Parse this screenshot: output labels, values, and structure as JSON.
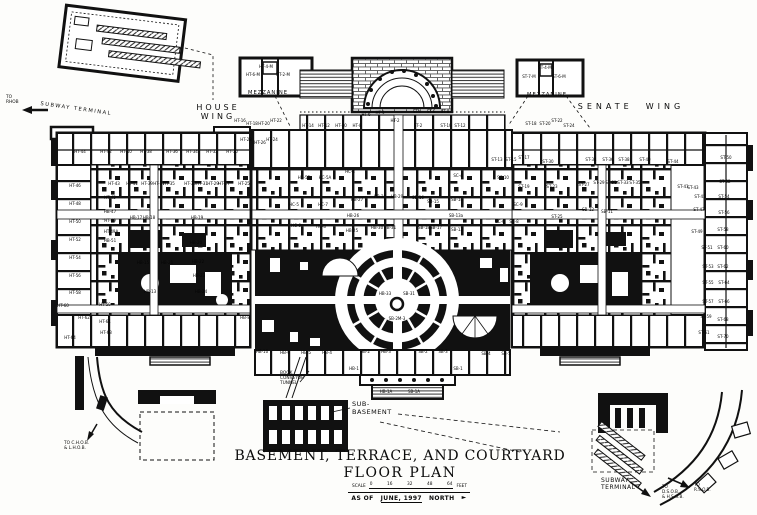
{
  "title": {
    "line1": "BASEMENT, TERRACE, AND COURTYARD",
    "line2": "FLOOR PLAN"
  },
  "scale_bar": {
    "label": "SCALE",
    "ticks": [
      "0",
      "16",
      "32",
      "48",
      "64"
    ],
    "unit": "FEET"
  },
  "date_line": {
    "as_of": "AS OF",
    "date": "JUNE, 1997",
    "north": "NORTH",
    "arrow": "►"
  },
  "annotations": [
    {
      "name": "to-rhob-label",
      "lines": [
        "TO",
        "RHOB"
      ],
      "x": 6,
      "y": 95,
      "size": 4.3
    },
    {
      "name": "nw-subway-terminal-label",
      "lines": [
        "SUBWAY TERMINAL"
      ],
      "x": 40,
      "y": 106,
      "size": 5.2,
      "ls": 1.5,
      "rotate": 8
    },
    {
      "name": "house-wing-label",
      "lines": [
        "HOUSE",
        "WING"
      ],
      "x": 218,
      "y": 103,
      "size": 8,
      "ls": 3,
      "center": true
    },
    {
      "name": "mezzanine-left-label",
      "lines": [
        "MEZZANINE"
      ],
      "x": 268,
      "y": 90,
      "size": 5.2,
      "ls": 1,
      "center": true
    },
    {
      "name": "mezzanine-right-label",
      "lines": [
        "MEZZANINE"
      ],
      "x": 547,
      "y": 92,
      "size": 5.2,
      "ls": 1,
      "center": true
    },
    {
      "name": "senate-wing-label",
      "lines": [
        "SENATE  WING"
      ],
      "x": 631,
      "y": 102,
      "size": 8,
      "ls": 4,
      "center": true
    },
    {
      "name": "book-conveyor-tunnel-label",
      "lines": [
        "BOOK",
        "CONVEYOR",
        "TUNNEL"
      ],
      "x": 280,
      "y": 371,
      "size": 4.3
    },
    {
      "name": "sub-basement-label",
      "lines": [
        "SUB-",
        "BASEMENT"
      ],
      "x": 352,
      "y": 401,
      "size": 6.5,
      "ls": 0.5
    },
    {
      "name": "to-chob-lhob-label",
      "lines": [
        "TO C.H.O.B.",
        "& L.H.O.B."
      ],
      "x": 64,
      "y": 441,
      "size": 4.3
    },
    {
      "name": "se-subway-terminal-label",
      "lines": [
        "SUBWAY",
        "TERMINAL"
      ],
      "x": 601,
      "y": 477,
      "size": 6,
      "ls": 0.5
    },
    {
      "name": "to-dsob-hsob-label",
      "lines": [
        "TO",
        "D.S.O.B.",
        "& H.S.O.B."
      ],
      "x": 662,
      "y": 485,
      "size": 4.2
    },
    {
      "name": "to-rsob-label",
      "lines": [
        "TO",
        "R.S.O.B."
      ],
      "x": 694,
      "y": 483,
      "size": 4.2
    }
  ],
  "room_labels": [
    {
      "t": "HT-44",
      "x": 80,
      "y": 152
    },
    {
      "t": "HT-42",
      "x": 106,
      "y": 152
    },
    {
      "t": "HT-40",
      "x": 126,
      "y": 152
    },
    {
      "t": "HT-38",
      "x": 146,
      "y": 152
    },
    {
      "t": "HT-36",
      "x": 172,
      "y": 152
    },
    {
      "t": "HT-34",
      "x": 192,
      "y": 152
    },
    {
      "t": "HT-32",
      "x": 212,
      "y": 152
    },
    {
      "t": "HT-30",
      "x": 232,
      "y": 152
    },
    {
      "t": "HT-28",
      "x": 246,
      "y": 140
    },
    {
      "t": "HT-26",
      "x": 260,
      "y": 143
    },
    {
      "t": "HT-24",
      "x": 272,
      "y": 140
    },
    {
      "t": "HT-43",
      "x": 114,
      "y": 184
    },
    {
      "t": "HT-41",
      "x": 132,
      "y": 184
    },
    {
      "t": "HT-39",
      "x": 147,
      "y": 184
    },
    {
      "t": "HT-37",
      "x": 159,
      "y": 184
    },
    {
      "t": "HT-35",
      "x": 169,
      "y": 184
    },
    {
      "t": "HT-33",
      "x": 190,
      "y": 184
    },
    {
      "t": "HT-31",
      "x": 202,
      "y": 184
    },
    {
      "t": "HT-29",
      "x": 213,
      "y": 184
    },
    {
      "t": "HT-27",
      "x": 224,
      "y": 184
    },
    {
      "t": "HT-25",
      "x": 244,
      "y": 184
    },
    {
      "t": "HT-46",
      "x": 75,
      "y": 186
    },
    {
      "t": "HT-48",
      "x": 75,
      "y": 204
    },
    {
      "t": "HT-50",
      "x": 75,
      "y": 222
    },
    {
      "t": "HT-52",
      "x": 75,
      "y": 240
    },
    {
      "t": "HT-54",
      "x": 75,
      "y": 258
    },
    {
      "t": "HT-56",
      "x": 75,
      "y": 276
    },
    {
      "t": "HT-58",
      "x": 75,
      "y": 293
    },
    {
      "t": "HT-60",
      "x": 63,
      "y": 306
    },
    {
      "t": "HT-62",
      "x": 84,
      "y": 318
    },
    {
      "t": "HT-64",
      "x": 70,
      "y": 338
    },
    {
      "t": "HT-45",
      "x": 110,
      "y": 198
    },
    {
      "t": "HB-47",
      "x": 110,
      "y": 212
    },
    {
      "t": "HT-49",
      "x": 110,
      "y": 221
    },
    {
      "t": "HT-49A",
      "x": 111,
      "y": 232
    },
    {
      "t": "HB-51",
      "x": 110,
      "y": 241
    },
    {
      "t": "HB-17",
      "x": 136,
      "y": 218
    },
    {
      "t": "HB-18",
      "x": 149,
      "y": 218
    },
    {
      "t": "HB-19",
      "x": 197,
      "y": 218
    },
    {
      "t": "HB-20",
      "x": 196,
      "y": 243
    },
    {
      "t": "HB-15",
      "x": 143,
      "y": 263
    },
    {
      "t": "HB-21",
      "x": 167,
      "y": 263
    },
    {
      "t": "HB-22",
      "x": 198,
      "y": 262
    },
    {
      "t": "HB-23",
      "x": 199,
      "y": 276
    },
    {
      "t": "HB-24",
      "x": 201,
      "y": 292
    },
    {
      "t": "HB-13",
      "x": 150,
      "y": 292
    },
    {
      "t": "HB-8",
      "x": 245,
      "y": 318
    },
    {
      "t": "HT-59",
      "x": 105,
      "y": 305
    },
    {
      "t": "HT-61",
      "x": 105,
      "y": 322
    },
    {
      "t": "HT-63",
      "x": 106,
      "y": 333
    },
    {
      "t": "HC-5B",
      "x": 304,
      "y": 178
    },
    {
      "t": "HC-5A",
      "x": 325,
      "y": 178
    },
    {
      "t": "HC-4",
      "x": 350,
      "y": 172
    },
    {
      "t": "HC-5",
      "x": 294,
      "y": 205
    },
    {
      "t": "HC-7",
      "x": 323,
      "y": 205
    },
    {
      "t": "HC-6",
      "x": 296,
      "y": 226
    },
    {
      "t": "HC-8",
      "x": 321,
      "y": 227
    },
    {
      "t": "HT-14",
      "x": 308,
      "y": 126
    },
    {
      "t": "HT-12",
      "x": 324,
      "y": 126
    },
    {
      "t": "HT-10",
      "x": 341,
      "y": 126
    },
    {
      "t": "HT-8",
      "x": 357,
      "y": 126
    },
    {
      "t": "HT-6",
      "x": 366,
      "y": 115
    },
    {
      "t": "HT-4",
      "x": 380,
      "y": 113
    },
    {
      "t": "HT-2",
      "x": 395,
      "y": 121
    },
    {
      "t": "ST-2",
      "x": 418,
      "y": 126
    },
    {
      "t": "ST-4",
      "x": 417,
      "y": 112
    },
    {
      "t": "ST-6",
      "x": 431,
      "y": 112
    },
    {
      "t": "ST-8",
      "x": 445,
      "y": 112
    },
    {
      "t": "ST-10",
      "x": 446,
      "y": 126
    },
    {
      "t": "ST-12",
      "x": 460,
      "y": 126
    },
    {
      "t": "HB-27",
      "x": 357,
      "y": 200
    },
    {
      "t": "HB-28",
      "x": 380,
      "y": 197
    },
    {
      "t": "HB-29",
      "x": 397,
      "y": 197
    },
    {
      "t": "SB-16",
      "x": 418,
      "y": 198
    },
    {
      "t": "SB-15",
      "x": 433,
      "y": 202
    },
    {
      "t": "SB-14",
      "x": 457,
      "y": 200
    },
    {
      "t": "SB-13a",
      "x": 456,
      "y": 216
    },
    {
      "t": "HB-26",
      "x": 353,
      "y": 216
    },
    {
      "t": "HB-25",
      "x": 352,
      "y": 231
    },
    {
      "t": "HB-30",
      "x": 377,
      "y": 228
    },
    {
      "t": "HB-31",
      "x": 390,
      "y": 228
    },
    {
      "t": "SB-18",
      "x": 424,
      "y": 228
    },
    {
      "t": "SB-17",
      "x": 436,
      "y": 228
    },
    {
      "t": "SB-13",
      "x": 457,
      "y": 230
    },
    {
      "t": "HB-33",
      "x": 385,
      "y": 294
    },
    {
      "t": "SB-31",
      "x": 409,
      "y": 294
    },
    {
      "t": "SB-2M-3",
      "x": 397,
      "y": 319
    },
    {
      "t": "HB-10",
      "x": 262,
      "y": 352
    },
    {
      "t": "HB-6",
      "x": 285,
      "y": 353
    },
    {
      "t": "HB-5",
      "x": 306,
      "y": 353
    },
    {
      "t": "HB-4",
      "x": 327,
      "y": 353
    },
    {
      "t": "HB-2",
      "x": 365,
      "y": 352
    },
    {
      "t": "HB-3",
      "x": 386,
      "y": 352
    },
    {
      "t": "SB-2",
      "x": 423,
      "y": 352
    },
    {
      "t": "SB-3",
      "x": 443,
      "y": 352
    },
    {
      "t": "SB-4",
      "x": 486,
      "y": 354
    },
    {
      "t": "SB-5",
      "x": 506,
      "y": 354
    },
    {
      "t": "HB-1",
      "x": 354,
      "y": 369
    },
    {
      "t": "SB-1",
      "x": 458,
      "y": 369
    },
    {
      "t": "HB-1A",
      "x": 386,
      "y": 392
    },
    {
      "t": "SB-1A",
      "x": 414,
      "y": 392
    },
    {
      "t": "ST-13",
      "x": 497,
      "y": 160
    },
    {
      "t": "ST-15",
      "x": 511,
      "y": 160
    },
    {
      "t": "ST-17",
      "x": 524,
      "y": 158
    },
    {
      "t": "ST-30",
      "x": 548,
      "y": 162
    },
    {
      "t": "ST-34",
      "x": 591,
      "y": 160
    },
    {
      "t": "ST-36",
      "x": 608,
      "y": 160
    },
    {
      "t": "ST-38",
      "x": 624,
      "y": 160
    },
    {
      "t": "ST-40",
      "x": 645,
      "y": 160
    },
    {
      "t": "ST-44",
      "x": 673,
      "y": 162
    },
    {
      "t": "ST-19",
      "x": 524,
      "y": 187
    },
    {
      "t": "ST-23",
      "x": 552,
      "y": 187
    },
    {
      "t": "ST-27",
      "x": 584,
      "y": 185
    },
    {
      "t": "ST-29",
      "x": 599,
      "y": 183
    },
    {
      "t": "ST-31",
      "x": 611,
      "y": 183
    },
    {
      "t": "ST-33",
      "x": 623,
      "y": 183
    },
    {
      "t": "ST-35",
      "x": 635,
      "y": 183
    },
    {
      "t": "ST-41",
      "x": 683,
      "y": 187
    },
    {
      "t": "ST-43",
      "x": 693,
      "y": 188
    },
    {
      "t": "SC-4",
      "x": 458,
      "y": 176
    },
    {
      "t": "SC-10",
      "x": 503,
      "y": 178
    },
    {
      "t": "SC-9",
      "x": 518,
      "y": 205
    },
    {
      "t": "SC-6",
      "x": 500,
      "y": 222
    },
    {
      "t": "SC-8",
      "x": 514,
      "y": 222
    },
    {
      "t": "ST-25",
      "x": 557,
      "y": 217
    },
    {
      "t": "SB-12",
      "x": 588,
      "y": 210
    },
    {
      "t": "SB-11",
      "x": 607,
      "y": 212
    },
    {
      "t": "ST-45",
      "x": 700,
      "y": 197
    },
    {
      "t": "ST-47",
      "x": 699,
      "y": 210
    },
    {
      "t": "ST-49",
      "x": 697,
      "y": 232
    },
    {
      "t": "ST-51",
      "x": 707,
      "y": 248
    },
    {
      "t": "ST-53",
      "x": 708,
      "y": 267
    },
    {
      "t": "ST-55",
      "x": 708,
      "y": 283
    },
    {
      "t": "ST-57",
      "x": 708,
      "y": 302
    },
    {
      "t": "ST-59",
      "x": 706,
      "y": 317
    },
    {
      "t": "ST-61",
      "x": 704,
      "y": 333
    },
    {
      "t": "ST-50",
      "x": 726,
      "y": 158
    },
    {
      "t": "ST-52",
      "x": 725,
      "y": 182
    },
    {
      "t": "ST-54",
      "x": 724,
      "y": 197
    },
    {
      "t": "ST-56",
      "x": 724,
      "y": 213
    },
    {
      "t": "ST-58",
      "x": 723,
      "y": 230
    },
    {
      "t": "ST-60",
      "x": 723,
      "y": 248
    },
    {
      "t": "ST-62",
      "x": 723,
      "y": 267
    },
    {
      "t": "ST-64",
      "x": 724,
      "y": 283
    },
    {
      "t": "ST-66",
      "x": 724,
      "y": 302
    },
    {
      "t": "ST-68",
      "x": 723,
      "y": 320
    },
    {
      "t": "ST-70",
      "x": 723,
      "y": 337
    },
    {
      "t": "HT-6-M",
      "x": 253,
      "y": 75
    },
    {
      "t": "HT-4-M",
      "x": 266,
      "y": 67
    },
    {
      "t": "HT-2-M",
      "x": 283,
      "y": 75
    },
    {
      "t": "ST-7-M",
      "x": 529,
      "y": 77
    },
    {
      "t": "ST-4-M",
      "x": 545,
      "y": 68
    },
    {
      "t": "ST-6-M",
      "x": 559,
      "y": 77
    },
    {
      "t": "ST-18",
      "x": 531,
      "y": 124
    },
    {
      "t": "ST-20",
      "x": 545,
      "y": 124
    },
    {
      "t": "ST-22",
      "x": 557,
      "y": 121
    },
    {
      "t": "ST-24",
      "x": 569,
      "y": 126
    },
    {
      "t": "HT-16",
      "x": 240,
      "y": 121
    },
    {
      "t": "HT-18",
      "x": 252,
      "y": 124
    },
    {
      "t": "HT-20",
      "x": 264,
      "y": 124
    },
    {
      "t": "HT-22",
      "x": 276,
      "y": 121
    }
  ]
}
